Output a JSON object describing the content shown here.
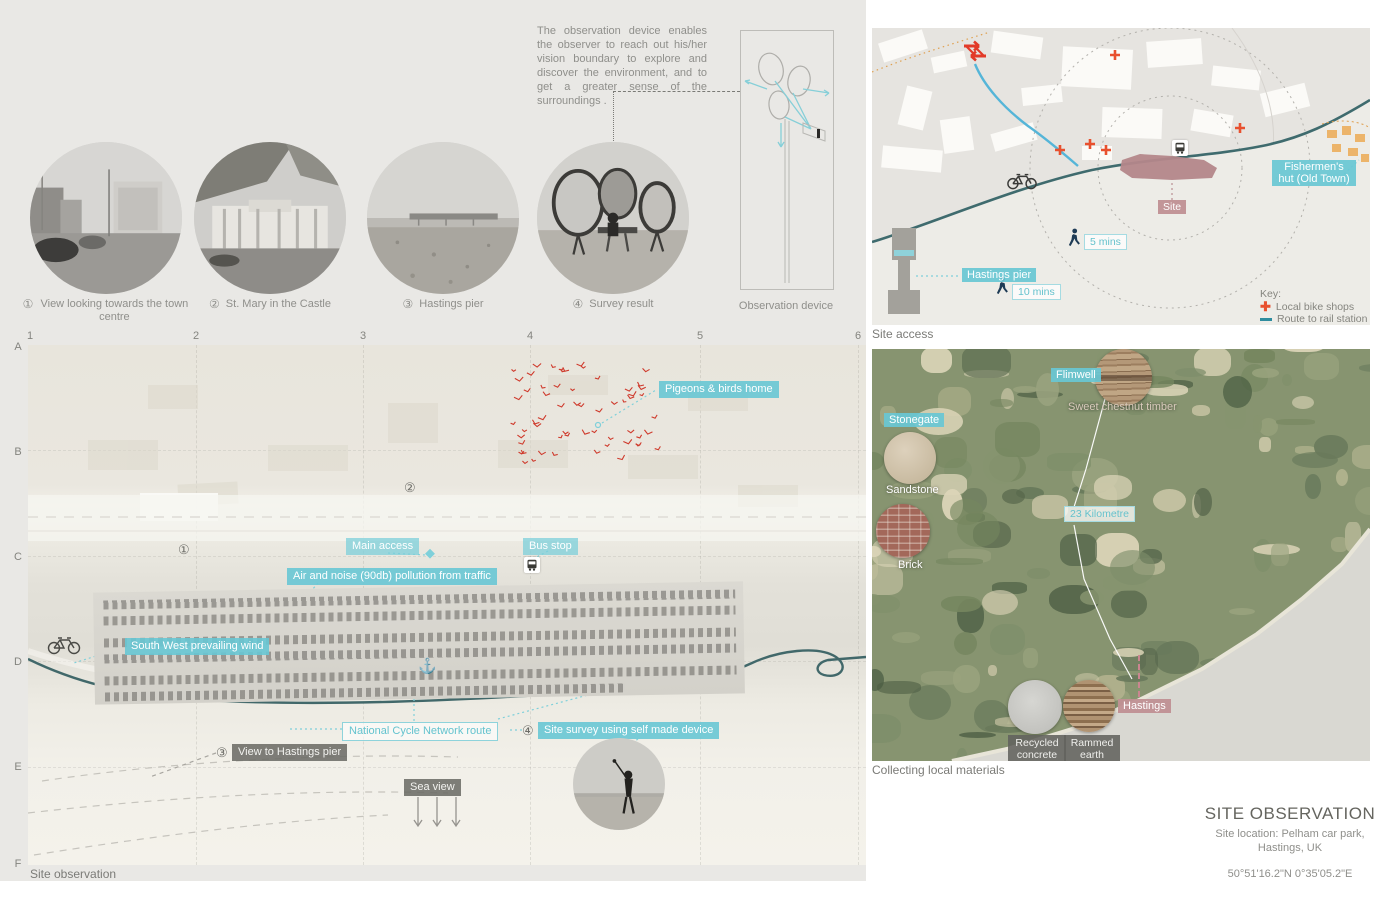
{
  "observation": {
    "description": "The observation device enables the observer to reach out his/her vision boundary to explore and discover the environment, and to get a greater sense of the surroundings .",
    "photos": [
      {
        "num": "①",
        "caption": "View looking towards the town centre"
      },
      {
        "num": "②",
        "caption": "St. Mary in the Castle"
      },
      {
        "num": "③",
        "caption": "Hastings pier"
      },
      {
        "num": "④",
        "caption": "Survey result"
      }
    ],
    "device_caption": "Observation device"
  },
  "site_access": {
    "caption": "Site access",
    "fishermens_hut": "Fishermen's hut (Old Town)",
    "site": "Site",
    "hastings_pier": "Hastings pier",
    "walk5": "5 mins",
    "walk10": "10 mins",
    "key_title": "Key:",
    "key_bike": "Local bike shops",
    "key_rail": "Route to rail station"
  },
  "site_plan": {
    "caption": "Site observation",
    "grid_cols": [
      "1",
      "2",
      "3",
      "4",
      "5",
      "6"
    ],
    "grid_rows": [
      "A",
      "B",
      "C",
      "D",
      "E",
      "F"
    ],
    "pigeons": "Pigeons & birds home",
    "main_access": "Main access",
    "bus_stop": "Bus stop",
    "air_noise": "Air and noise (90db) pollution from traffic",
    "wind": "South West prevailing wind",
    "cycle_route": "National Cycle Network route",
    "survey_num": "④",
    "survey": "Site survey using self made device",
    "view_pier_num": "③",
    "view_pier": "View to Hastings pier",
    "sea_view": "Sea view",
    "marker1": "①",
    "marker2": "②"
  },
  "materials": {
    "caption": "Collecting local materials",
    "flimwell": "Flimwell",
    "timber": "Sweet chestnut timber",
    "stonegate": "Stonegate",
    "sandstone": "Sandstone",
    "brick": "Brick",
    "distance": "23 Kilometre",
    "hastings": "Hastings",
    "concrete": "Recycled concrete",
    "earth": "Rammed earth"
  },
  "title_block": {
    "title": "SITE OBSERVATION",
    "location1": "Site location: Pelham car park,",
    "location2": "Hastings, UK",
    "coords": "50°51'16.2\"N 0°35'05.2\"E"
  },
  "colors": {
    "teal_label": "#68c7d4",
    "teal_route": "#41686a",
    "rose": "#c4898f",
    "gray_label": "#6c6c67",
    "rail_red": "#e8432e",
    "navy_walker": "#1e3b55",
    "bird_red": "#cf3a2c",
    "blue_route": "#55b5d8"
  }
}
